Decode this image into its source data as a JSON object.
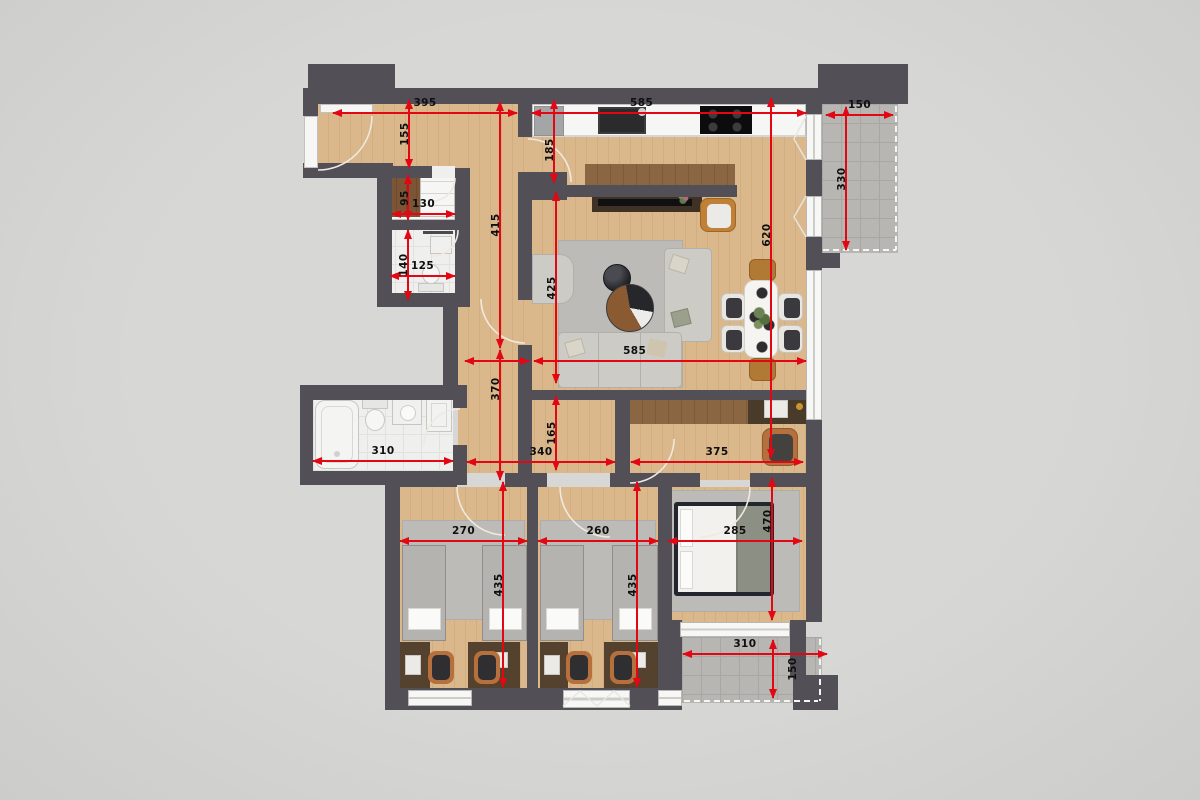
{
  "colors": {
    "background": "#d3d3d1",
    "wall": "#524f57",
    "dimension_red": "#e30613",
    "label_black": "#0f0f0f",
    "wood_floor": "#d6b385",
    "balcony_tile": "#b7b6b3",
    "bathroom_tile": "#efefed"
  },
  "dimensions_cm": [
    {
      "value": "395",
      "o": "h",
      "x": 333,
      "y": 113,
      "len": 184
    },
    {
      "value": "585",
      "o": "h",
      "x": 532,
      "y": 113,
      "len": 274,
      "lp": 0.4
    },
    {
      "value": "150",
      "o": "h",
      "x": 826,
      "y": 115,
      "len": 67
    },
    {
      "value": "130",
      "o": "h",
      "x": 392,
      "y": 214,
      "len": 63
    },
    {
      "value": "125",
      "o": "h",
      "x": 390,
      "y": 276,
      "len": 65
    },
    {
      "value": "",
      "o": "h",
      "x": 465,
      "y": 361,
      "len": 64
    },
    {
      "value": "585",
      "o": "h",
      "x": 534,
      "y": 361,
      "len": 272,
      "lp": 0.37
    },
    {
      "value": "310",
      "o": "h",
      "x": 313,
      "y": 461,
      "len": 140
    },
    {
      "value": "340",
      "o": "h",
      "x": 467,
      "y": 462,
      "len": 148
    },
    {
      "value": "375",
      "o": "h",
      "x": 631,
      "y": 462,
      "len": 172
    },
    {
      "value": "270",
      "o": "h",
      "x": 400,
      "y": 541,
      "len": 127
    },
    {
      "value": "260",
      "o": "h",
      "x": 538,
      "y": 541,
      "len": 120
    },
    {
      "value": "285",
      "o": "h",
      "x": 668,
      "y": 541,
      "len": 134
    },
    {
      "value": "310",
      "o": "h",
      "x": 683,
      "y": 654,
      "len": 144,
      "lp": 0.43
    },
    {
      "value": "155",
      "o": "v",
      "x": 409,
      "y": 100,
      "len": 68
    },
    {
      "value": "95",
      "o": "v",
      "x": 408,
      "y": 175,
      "len": 45
    },
    {
      "value": "140",
      "o": "v",
      "x": 408,
      "y": 230,
      "len": 70
    },
    {
      "value": "415",
      "o": "v",
      "x": 500,
      "y": 102,
      "len": 246
    },
    {
      "value": "370",
      "o": "v",
      "x": 500,
      "y": 350,
      "len": 130,
      "lp": 0.3
    },
    {
      "value": "435",
      "o": "v",
      "x": 503,
      "y": 482,
      "len": 205
    },
    {
      "value": "435",
      "o": "v",
      "x": 637,
      "y": 482,
      "len": 205
    },
    {
      "value": "185",
      "o": "v",
      "x": 554,
      "y": 100,
      "len": 83,
      "lp": 0.6
    },
    {
      "value": "425",
      "o": "v",
      "x": 556,
      "y": 192,
      "len": 191
    },
    {
      "value": "165",
      "o": "v",
      "x": 556,
      "y": 396,
      "len": 74
    },
    {
      "value": "620",
      "o": "v",
      "x": 771,
      "y": 98,
      "len": 360,
      "lp": 0.38
    },
    {
      "value": "330",
      "o": "v",
      "x": 846,
      "y": 107,
      "len": 143
    },
    {
      "value": "470",
      "o": "v",
      "x": 772,
      "y": 478,
      "len": 142,
      "lp": 0.3
    },
    {
      "value": "150",
      "o": "v",
      "x": 773,
      "y": 640,
      "len": 58,
      "side": "right"
    }
  ]
}
